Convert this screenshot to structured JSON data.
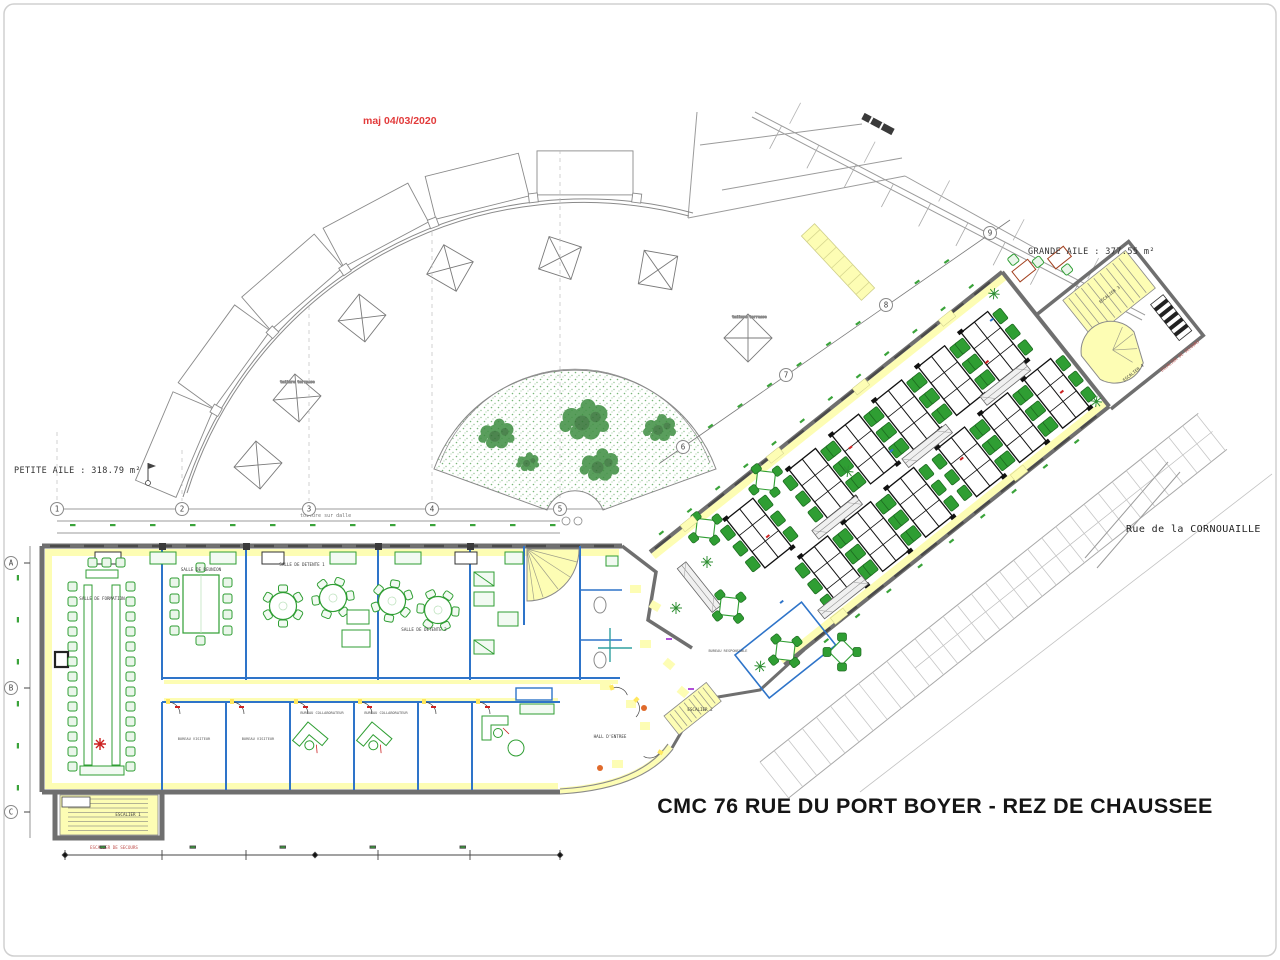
{
  "title": "CMC 76 RUE DU PORT BOYER - REZ DE CHAUSSEE",
  "revision_note": "maj 04/03/2020",
  "areas": {
    "petite_aile": "PETITE AILE : 318.79 m²",
    "grande_aile": "GRANDE AILE : 377.55 m²"
  },
  "street_label": "Rue de la CORNOUAILLE",
  "roof_labels": {
    "terrasse_1": "toiture terrasse",
    "terrasse_2": "toiture terrasse",
    "sur_dalle": "toiture sur dalle"
  },
  "rooms": {
    "salle_formation": "SALLE DE FORMATION",
    "salle_reunion": "SALLE DE REUNION",
    "salle_detente_1": "SALLE DE DETENTE 1",
    "salle_detente_2": "SALLE DE DETENTE 2",
    "hall_entree": "HALL D'ENTREE",
    "bureau_responsable": "BUREAU RESPONSABLE",
    "bureau_visiteur_1": "BUREAU VISITEUR",
    "bureau_visiteur_2": "BUREAU VISITEUR",
    "bureau_collaborateur_1": "BUREAU COLLABORATEUR",
    "bureau_collaborateur_2": "BUREAU COLLABORATEUR"
  },
  "stairs": {
    "escalier_1": "ESCALIER 1",
    "escalier_2": "ESCALIER 2",
    "escalier_3": "ESCALIER 3",
    "escalier_4": "ESCALIER 4",
    "escalier_secours": "ESCALIER DE SECOURS"
  },
  "grid": {
    "columns": [
      "1",
      "2",
      "3",
      "4",
      "5",
      "6",
      "7",
      "8",
      "9"
    ],
    "rows": [
      "A",
      "B",
      "C"
    ]
  },
  "colors": {
    "wall_gray": "#6f6f6f",
    "partition_blue": "#2e74c9",
    "furniture_green": "#2f9e33",
    "highlight_yellow": "#fdfdb4",
    "vegetation_green": "#3e8e41",
    "revision_red": "#e23b3b",
    "secours_red": "#c0504d",
    "line_gray": "#9b9b9b"
  }
}
